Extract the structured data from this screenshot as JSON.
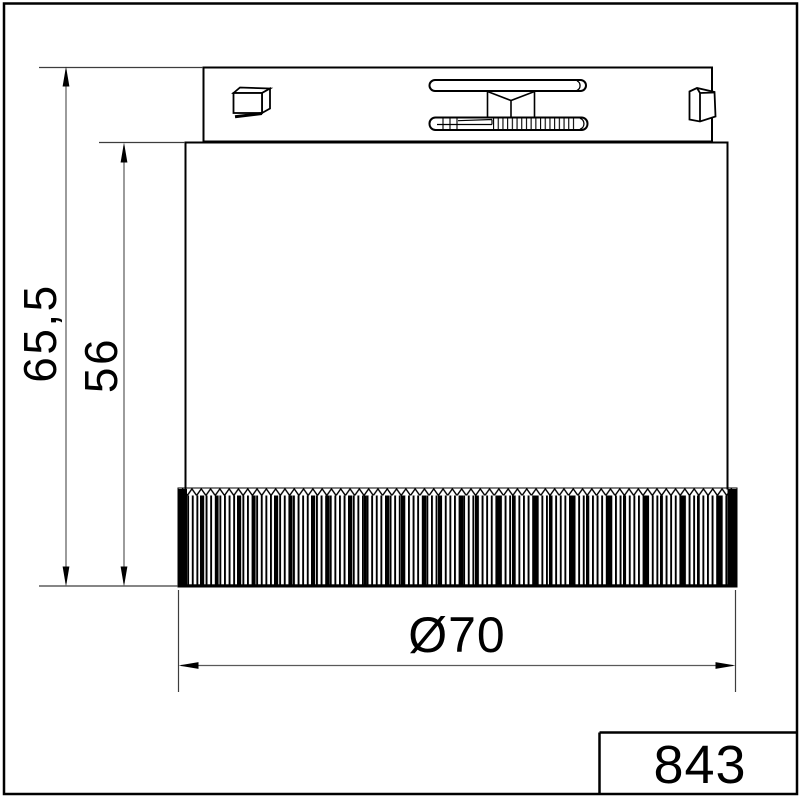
{
  "drawing": {
    "dimension_overall_height": "65,5",
    "dimension_body_height": "56",
    "dimension_diameter": "Ø70",
    "part_number": "843"
  },
  "colors": {
    "outline": "#000000",
    "dimension_line": "#595959",
    "extension_line": "#3d3d3d",
    "background": "#ffffff"
  }
}
